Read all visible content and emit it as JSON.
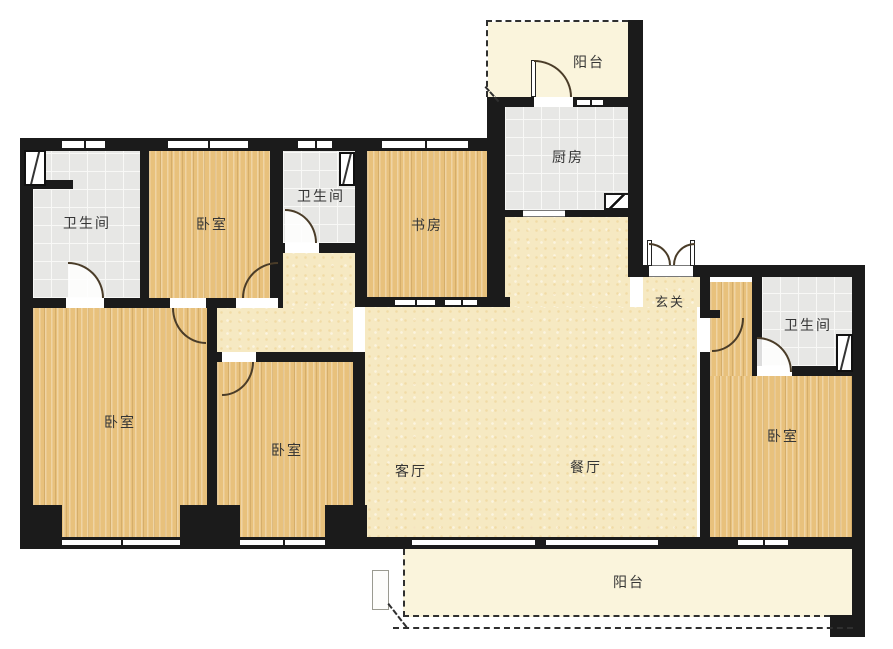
{
  "title": "户型图",
  "rooms": {
    "bathroom_top_left": {
      "label": "卫生间"
    },
    "bedroom_top_left": {
      "label": "卧室"
    },
    "bathroom_top_mid": {
      "label": "卫生间"
    },
    "study": {
      "label": "书房"
    },
    "balcony_top": {
      "label": "阳台"
    },
    "kitchen": {
      "label": "厨房"
    },
    "entry": {
      "label": "玄关"
    },
    "bathroom_right": {
      "label": "卫生间"
    },
    "bedroom_right": {
      "label": "卧室"
    },
    "bedroom_left": {
      "label": "卧室"
    },
    "bedroom_mid": {
      "label": "卧室"
    },
    "living": {
      "label": "客厅"
    },
    "dining": {
      "label": "餐厅"
    },
    "balcony_bottom": {
      "label": "阳台"
    }
  },
  "colors": {
    "wall": "#1b1b1b",
    "wood": "#e8c17c",
    "tile": "#e7e7e5",
    "cream": "#f6e9c2",
    "pale": "#faf4dc",
    "door": "#4a3c28"
  }
}
